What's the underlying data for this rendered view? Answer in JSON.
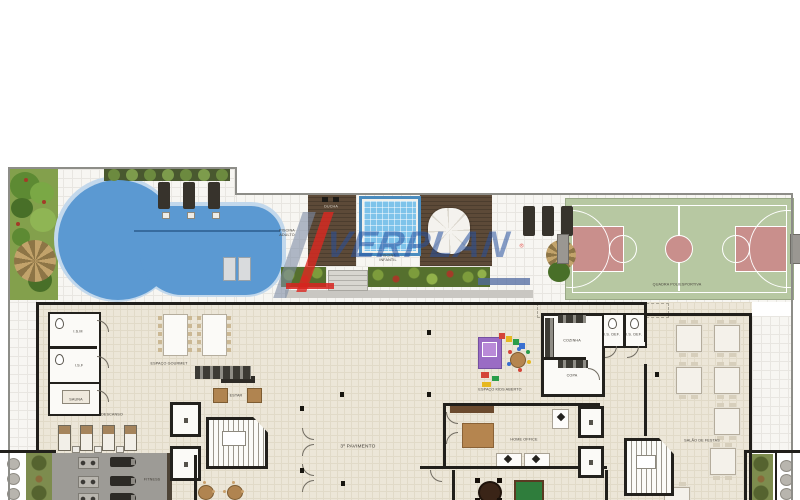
{
  "watermark": {
    "brand": "VERPLAN",
    "registered": "®",
    "brand_blue": "#2a55a0",
    "slash_red": "#dc2820",
    "slash_gray": "#7d8ca5"
  },
  "outdoor_labels": {
    "ducha": "DUCHA",
    "piscina_adulto": "PISCINA\nADULTO",
    "piscina_infantil": "PISCINA\nINFANTIL",
    "quadra": "QUADRA POLIESPORTIVA"
  },
  "indoor_labels": {
    "floor": "3º PAVIMENTO",
    "ism": "I.S.M",
    "isf": "I.S.F",
    "sauna": "SAUNA",
    "gourmet": "ESPAÇO GOURMET",
    "estar": "ESTAR",
    "descanso": "DESCANSO",
    "fitness": "FITNESS",
    "kids": "ESPAÇO KIDS ABERTO",
    "cozinha": "COZINHA",
    "copa": "COPA",
    "isdef1": "I.S. DEF.",
    "isdef2": "I.S. DEF.",
    "home_office": "HOME OFFICE",
    "salao": "SALÃO DE FESTAS"
  },
  "palette": {
    "pool_blue": "#5b99d2",
    "court_green": "#b7c8a2",
    "court_key_red": "#c98f8c",
    "deck_wood": "#5d4a38",
    "floor_cream": "#ece6d8",
    "fitness_gray": "#9d9b96"
  }
}
